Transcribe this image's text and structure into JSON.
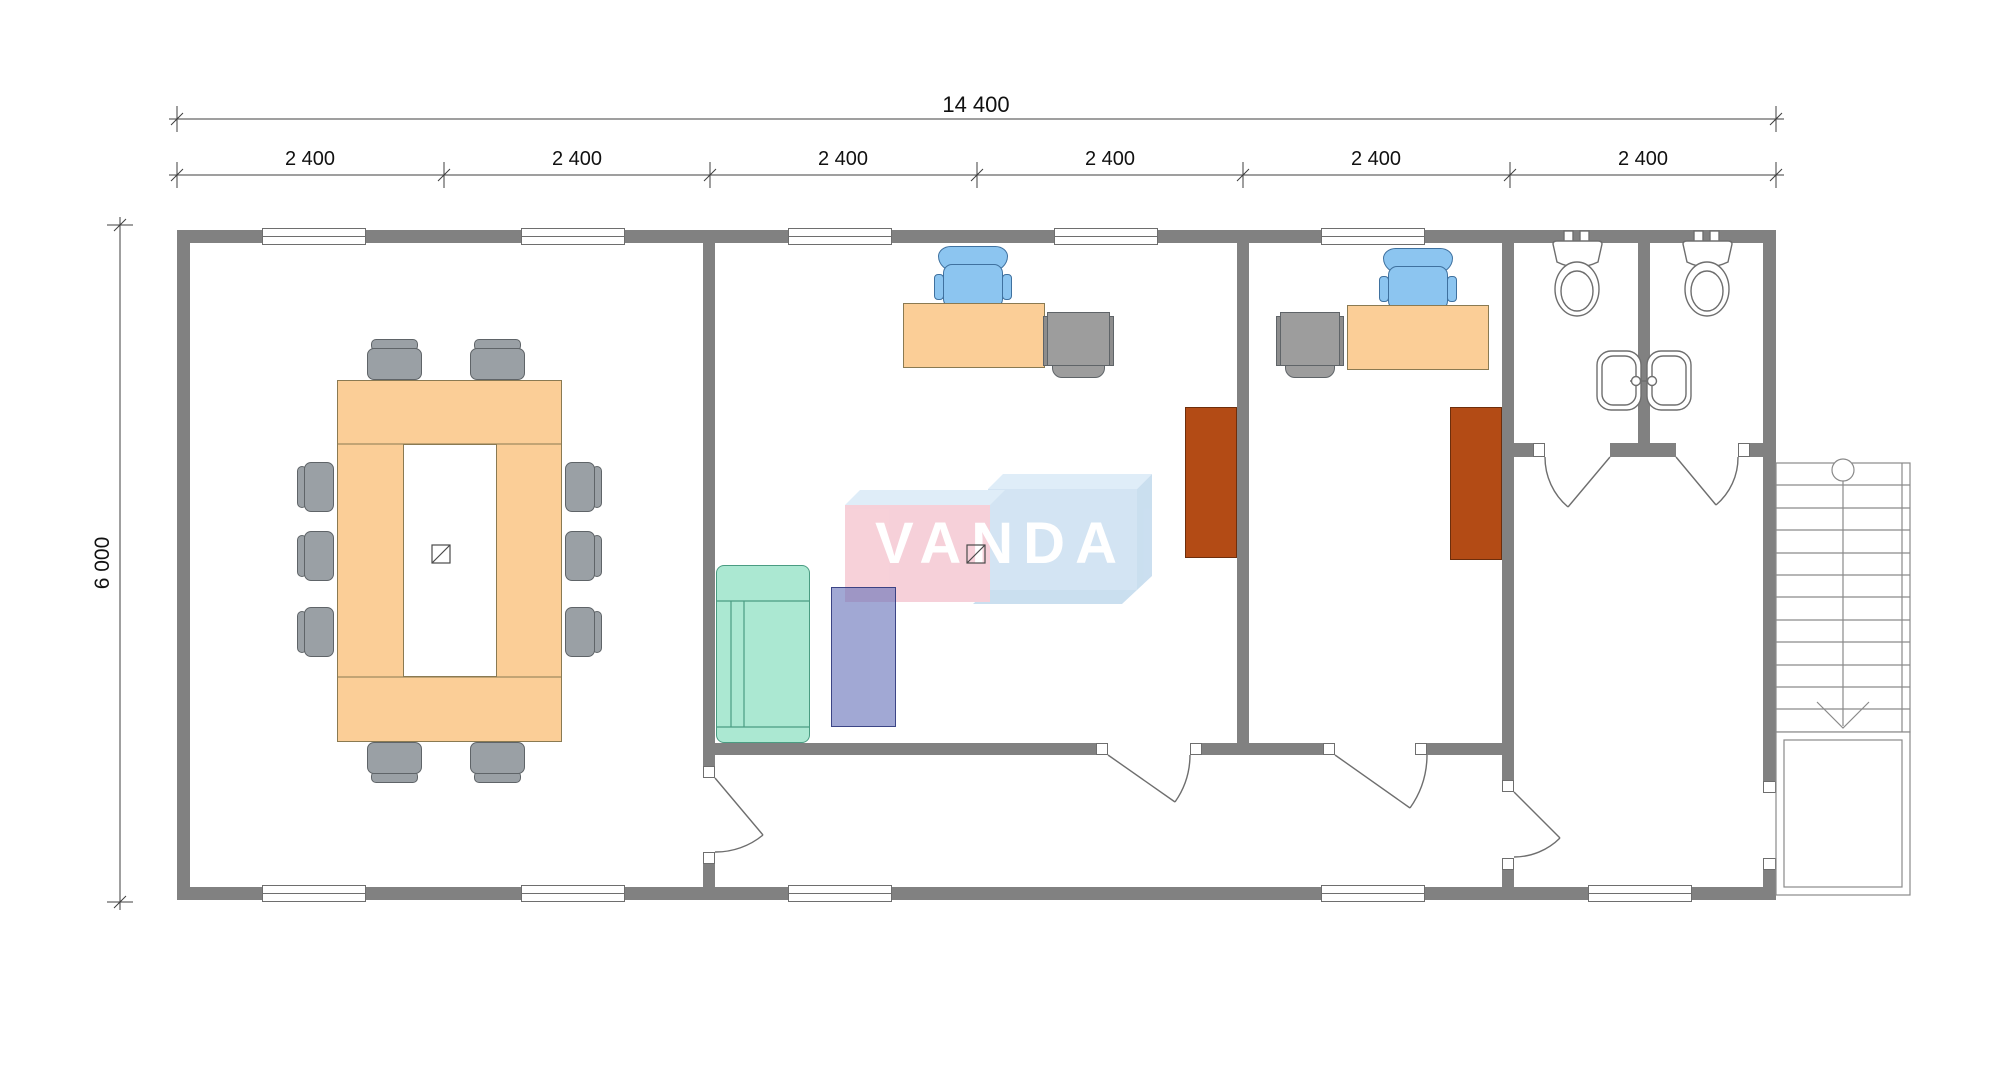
{
  "dimensions": {
    "total_width": "14 400",
    "bay_widths": [
      "2 400",
      "2 400",
      "2 400",
      "2 400",
      "2 400",
      "2 400"
    ],
    "total_height": "6 000"
  },
  "logo": {
    "text": "VANDA"
  },
  "colors": {
    "wall": "#818181",
    "line": "#6e6e6e",
    "dim": "#3f3f3f",
    "desk": "#fbce97",
    "desk_border": "#8a7a52",
    "chair": "#9aa0a5",
    "chair_border": "#5f6468",
    "chair_blue": "#8cc5f0",
    "chair_blue_border": "#3f719f",
    "cabinet": "#9d9d9d",
    "cabinet_brown": "#b34b15",
    "cabinet_brown_border": "#6d2e0c",
    "sofa": "#abe8d2",
    "sofa_border": "#4a9c82",
    "coffee_table": "rgba(99,110,183,0.6)",
    "coffee_table_border": "rgba(42,52,120,0.85)",
    "logo_pink": "#f6ccd5",
    "logo_blue": "#cfe2f2",
    "logo_bevel_light": "#dcecf8",
    "logo_bevel_mid": "#c5dcee",
    "logo_text": "#ffffff"
  }
}
